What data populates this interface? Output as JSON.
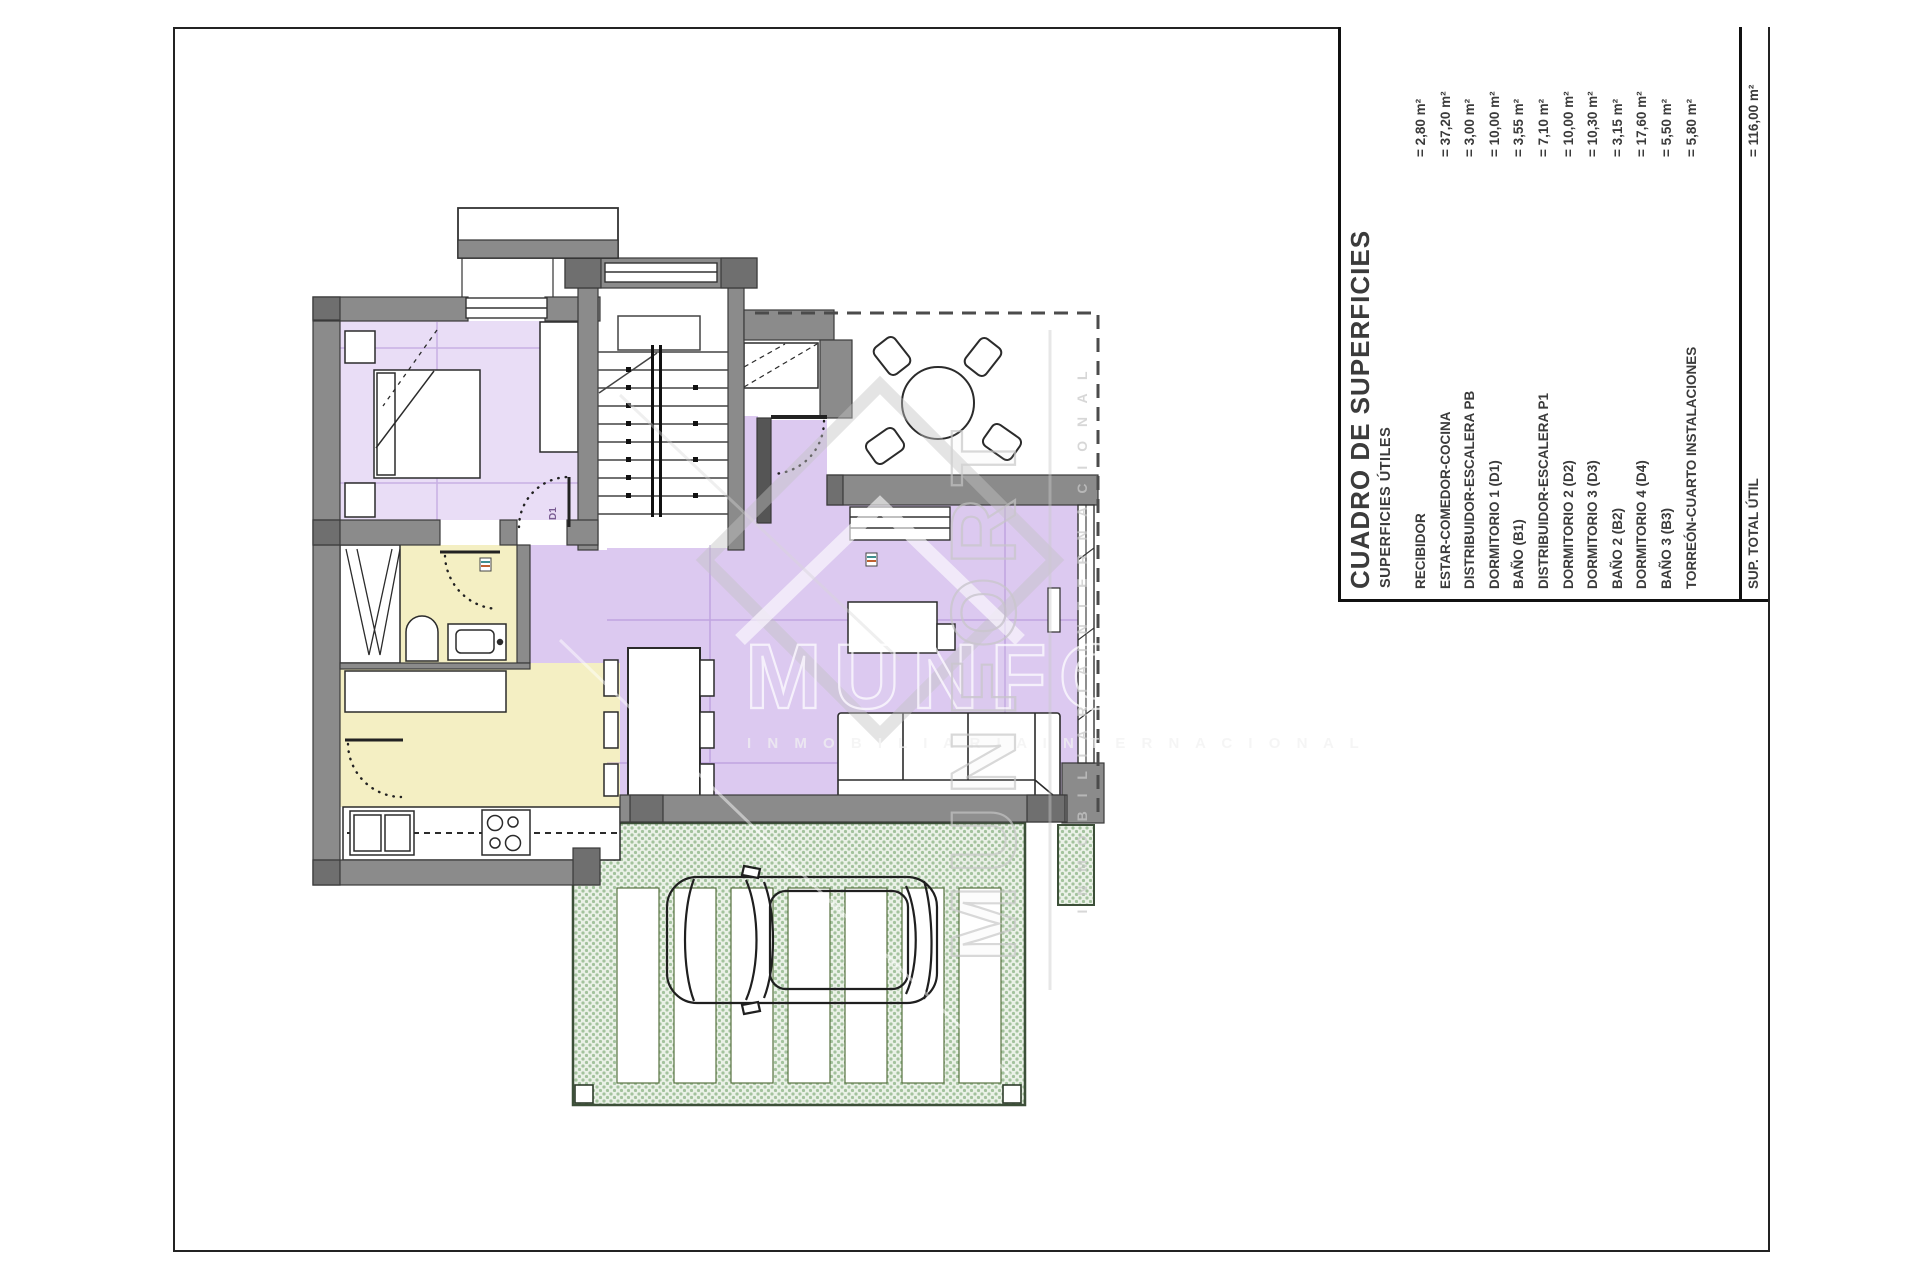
{
  "table": {
    "title": "CUADRO DE SUPERFICIES",
    "subtitle": "SUPERFICIES ÚTILES",
    "rows": [
      {
        "label": "RECIBIDOR",
        "value": "= 2,80 m²"
      },
      {
        "label": "ESTAR-COMEDOR-COCINA",
        "value": "= 37,20 m²"
      },
      {
        "label": "DISTRIBUIDOR-ESCALERA PB",
        "value": "= 3,00 m²"
      },
      {
        "label": "DORMITORIO 1 (D1)",
        "value": "= 10,00 m²"
      },
      {
        "label": "BAÑO (B1)",
        "value": "= 3,55 m²"
      },
      {
        "label": "DISTRIBUIDOR-ESCALERA P1",
        "value": "= 7,10 m²"
      },
      {
        "label": "DORMITORIO 2 (D2)",
        "value": "= 10,00 m²"
      },
      {
        "label": "DORMITORIO 3 (D3)",
        "value": "= 10,30 m²"
      },
      {
        "label": "BAÑO 2 (B2)",
        "value": "= 3,15 m²"
      },
      {
        "label": "DORMITORIO 4 (D4)",
        "value": "= 17,60 m²"
      },
      {
        "label": "BAÑO 3 (B3)",
        "value": "= 5,50 m²"
      },
      {
        "label": "TORREÓN-CUARTO INSTALACIONES",
        "value": "= 5,80 m²"
      }
    ],
    "total_label": "SUP. TOTAL ÚTIL",
    "total_value": "= 116,00 m²"
  },
  "watermark": {
    "brand": "MUNFORT",
    "tagline": "I N M O B I L I A R I A   I N T E R N A C I O N A L"
  },
  "plan_labels": {
    "bedroom_door": "D1"
  },
  "colors": {
    "wall_gray": "#8b8b8b",
    "room_lilac": "#dcc9f0",
    "room_lilac_light": "#e9ddf6",
    "room_yellow": "#f4efc3",
    "terrace_green_dot": "#a3c29d",
    "watermark_gray": "#c6c6c6"
  }
}
